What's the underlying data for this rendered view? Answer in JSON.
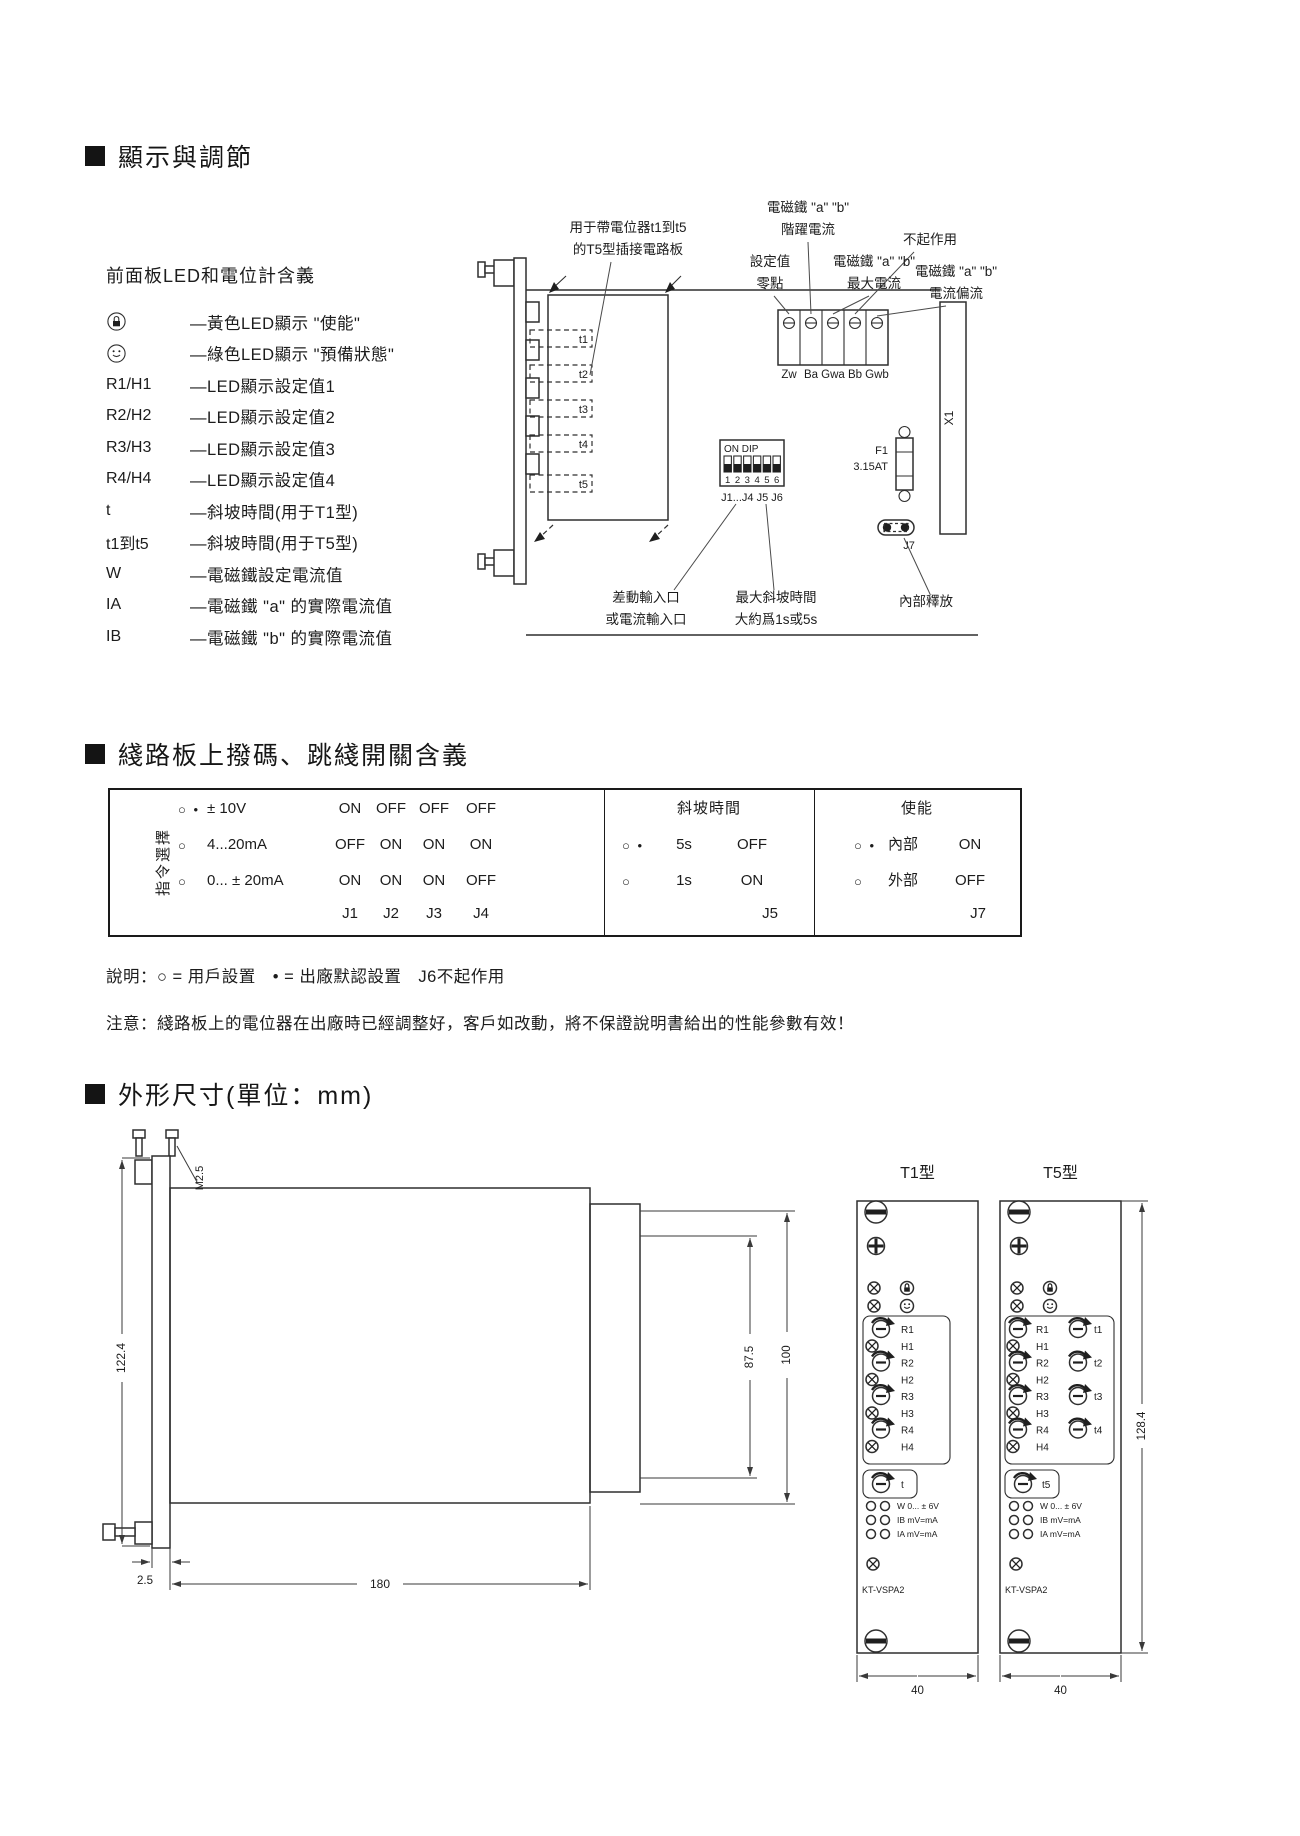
{
  "sections": {
    "display_adjust": "顯示與調節",
    "dip_meaning": "綫路板上撥碼、跳綫開關含義",
    "dimensions": "外形尺寸(單位：mm)"
  },
  "legend": {
    "title": "前面板LED和電位計含義",
    "items": [
      {
        "key": "",
        "desc": "—黃色LED顯示 \"使能\""
      },
      {
        "key": "",
        "desc": "—綠色LED顯示 \"預備狀態\""
      },
      {
        "key": "R1/H1",
        "desc": "—LED顯示設定值1"
      },
      {
        "key": "R2/H2",
        "desc": "—LED顯示設定值2"
      },
      {
        "key": "R3/H3",
        "desc": "—LED顯示設定值3"
      },
      {
        "key": "R4/H4",
        "desc": "—LED顯示設定值4"
      },
      {
        "key": "t",
        "desc": "—斜坡時間(用于T1型)"
      },
      {
        "key": "t1到t5",
        "desc": "—斜坡時間(用于T5型)"
      },
      {
        "key": "W",
        "desc": "—電磁鐵設定電流值"
      },
      {
        "key": "IA",
        "desc": "—電磁鐵 \"a\" 的實際電流值"
      },
      {
        "key": "IB",
        "desc": "—電磁鐵 \"b\" 的實際電流值"
      }
    ]
  },
  "diagram": {
    "callouts": {
      "t5_board_1": "用于帶電位器t1到t5",
      "t5_board_2": "的T5型插接電路板",
      "step_1": "電磁鐵 \"a\" \"b\"",
      "step_2": "階躍電流",
      "inactive": "不起作用",
      "zero_1": "設定值",
      "zero_2": "零點",
      "max_1": "電磁鐵 \"a\" \"b\"",
      "max_2": "最大電流",
      "bias_1": "電磁鐵 \"a\" \"b\"",
      "bias_2": "電流偏流",
      "input_1": "差動輸入口",
      "input_2": "或電流輸入口",
      "ramp_1": "最大斜坡時間",
      "ramp_2": "大約爲1s或5s",
      "release": "內部釋放"
    },
    "terminals": [
      "Zw",
      "Ba",
      "Gwa",
      "Bb",
      "Gwb"
    ],
    "pots": [
      "t1",
      "t2",
      "t3",
      "t4",
      "t5"
    ],
    "dip": {
      "label": "ON DIP",
      "numbers": [
        "1",
        "2",
        "3",
        "4",
        "5",
        "6"
      ],
      "jumpers": "J1...J4  J5  J6"
    },
    "fuse": {
      "name": "F1",
      "rating": "3.15AT"
    },
    "j7": "J7",
    "x1": "X1"
  },
  "jumper_table": {
    "cmd_select_label": "指令選擇",
    "cmd_rows": [
      {
        "mark": "○ •",
        "label": "± 10V",
        "values": [
          "ON",
          "OFF",
          "OFF",
          "OFF"
        ]
      },
      {
        "mark": "○",
        "label": "4...20mA",
        "values": [
          "OFF",
          "ON",
          "ON",
          "ON"
        ]
      },
      {
        "mark": "○",
        "label": "0... ± 20mA",
        "values": [
          "ON",
          "ON",
          "ON",
          "OFF"
        ]
      }
    ],
    "cmd_jumpers": [
      "J1",
      "J2",
      "J3",
      "J4"
    ],
    "ramp_header": "斜坡時間",
    "ramp_rows": [
      {
        "mark": "○ •",
        "label": "5s",
        "value": "OFF"
      },
      {
        "mark": "○",
        "label": "1s",
        "value": "ON"
      }
    ],
    "ramp_jumper": "J5",
    "enable_header": "使能",
    "enable_rows": [
      {
        "mark": "○ •",
        "label": "內部",
        "value": "ON"
      },
      {
        "mark": "○",
        "label": "外部",
        "value": "OFF"
      }
    ],
    "enable_jumper": "J7"
  },
  "notes": {
    "legend_note": "說明：○ = 用戶設置　• = 出廠默認設置　J6不起作用",
    "caution": "注意：綫路板上的電位器在出廠時已經調整好，客戶如改動，將不保證說明書給出的性能參數有效！"
  },
  "outline": {
    "side": {
      "m": "M2.5",
      "height": "122.4",
      "h_inner": "87.5",
      "h_outer": "100",
      "offset": "2.5",
      "length": "180"
    },
    "t1": {
      "title": "T1型",
      "width": "40"
    },
    "t5": {
      "title": "T5型",
      "width": "40",
      "height": "128.4"
    },
    "panel": {
      "r_labels": [
        "R1",
        "R2",
        "R3",
        "R4"
      ],
      "h_labels": [
        "H1",
        "H2",
        "H3",
        "H4"
      ],
      "t_label": "t",
      "t_labels": [
        "t1",
        "t2",
        "t3",
        "t4"
      ],
      "t5_label": "t5",
      "line_w": "W 0... ± 6V",
      "line_ib": "IB mV=mA",
      "line_ia": "IA mV=mA",
      "model": "KT-VSPA2"
    }
  }
}
